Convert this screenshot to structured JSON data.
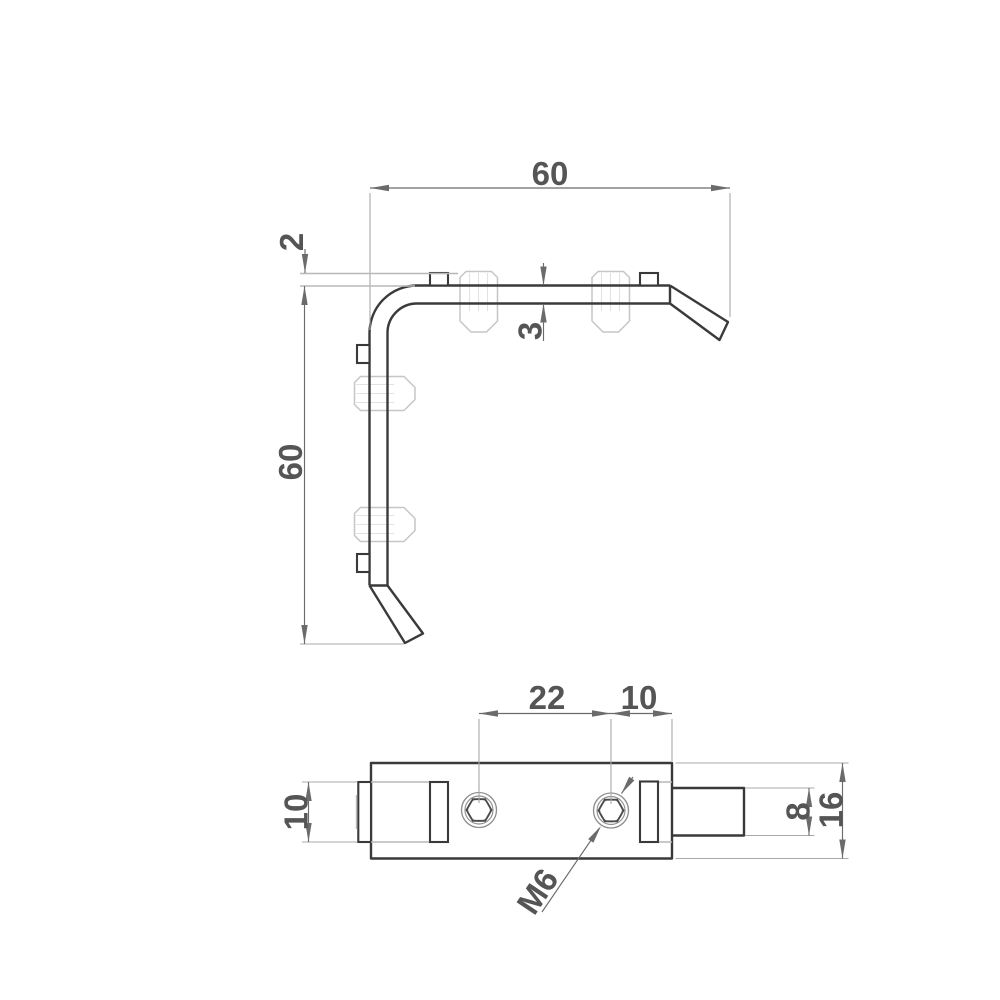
{
  "title": "Corner bracket engineering drawing, two views with dimensions",
  "colors": {
    "background": "#ffffff",
    "outline": "#3a3a3a",
    "phantom": "#c6c6c6",
    "faint": "#e2e2e2",
    "dimension": "#6b6b6b",
    "extension": "#a8a8a8",
    "groove": "#b8b8b8",
    "circles": "#8f8f8f",
    "hexes": "#4a4a4a",
    "text": "#555555"
  },
  "views": {
    "front": {
      "name": "L-bracket front view",
      "dims": {
        "width": "60",
        "height": "60",
        "tab_offset": "2",
        "material_thickness": "3"
      }
    },
    "bottom": {
      "name": "bracket bottom view",
      "dims": {
        "hole_spacing": "22",
        "hole_to_edge": "10",
        "tab_width": "10",
        "stud_height": "8",
        "profile_height": "16",
        "thread": "M6"
      }
    }
  }
}
